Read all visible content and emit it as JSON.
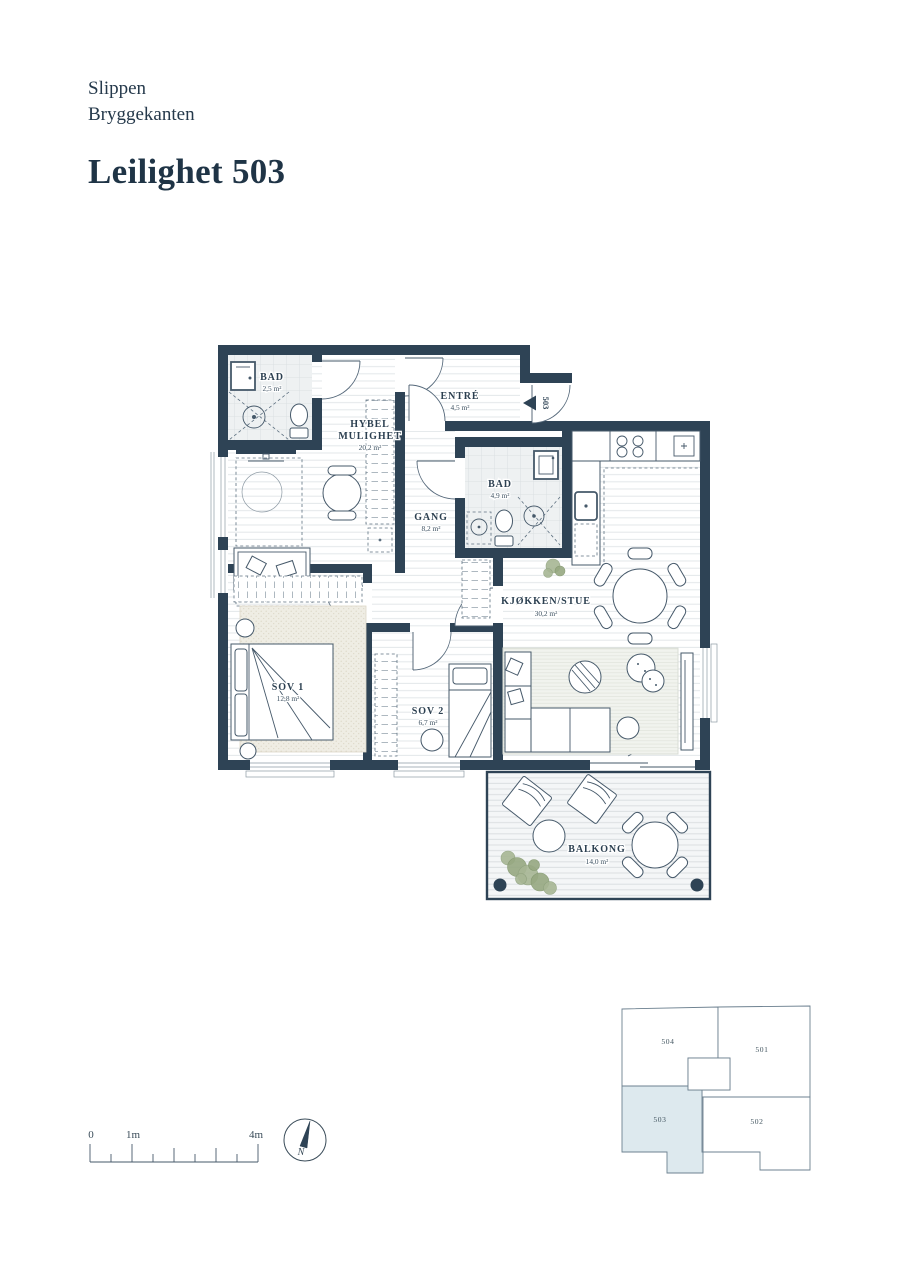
{
  "header": {
    "project": "Slippen",
    "subtitle": "Bryggekanten",
    "title": "Leilighet 503"
  },
  "floorplan": {
    "entry_marker": "503",
    "rooms": {
      "bad1": {
        "name": "BAD",
        "area": "2,5 m²"
      },
      "hybel": {
        "name_line1": "HYBEL",
        "name_line2": "MULIGHET",
        "area": "20,2 m²"
      },
      "entre": {
        "name": "ENTRÉ",
        "area": "4,5 m²"
      },
      "gang": {
        "name": "GANG",
        "area": "8,2 m²"
      },
      "bad2": {
        "name": "BAD",
        "area": "4,9 m²"
      },
      "kjokken_stue": {
        "name": "KJØKKEN/STUE",
        "area": "30,2 m²"
      },
      "sov1": {
        "name": "SOV 1",
        "area": "12,8 m²"
      },
      "sov2": {
        "name": "SOV 2",
        "area": "6,7 m²"
      },
      "balkong": {
        "name": "BALKONG",
        "area": "14,0 m²"
      }
    },
    "daybed_note": "GARDEROBE"
  },
  "scale_bar": {
    "labels": [
      "0",
      "1m",
      "4m"
    ]
  },
  "compass": {
    "north_label": "N"
  },
  "key_plan": {
    "units": [
      {
        "id": "504",
        "highlighted": false
      },
      {
        "id": "501",
        "highlighted": false
      },
      {
        "id": "503",
        "highlighted": true
      },
      {
        "id": "502",
        "highlighted": false
      }
    ]
  },
  "colors": {
    "wall": "#2e4355",
    "heading_text": "#1f3446",
    "key_plan_highlight": "#dde9ee",
    "plant_green": "#a7b694"
  }
}
